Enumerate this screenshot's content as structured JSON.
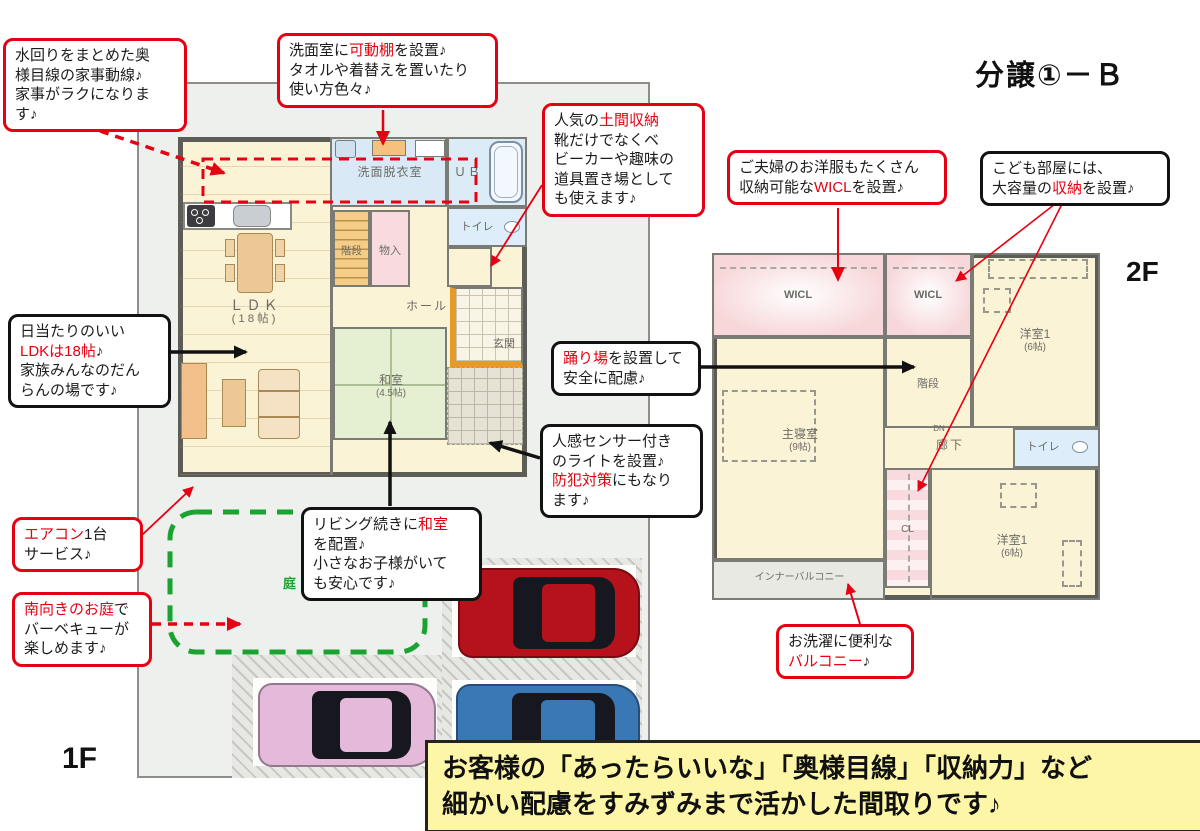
{
  "title": "分譲①－Ｂ",
  "labels": {
    "floor1": "1F",
    "floor2": "2F",
    "garden": "庭",
    "dn": "DN"
  },
  "banner": {
    "text": "お客様の「あったらいいな」「奥様目線」「収納力」など\n細かい配慮をすみずみまで活かした間取りです♪"
  },
  "colors": {
    "accent_red": "#e60012",
    "garden_green": "#1aa330",
    "banner_yellow": "#fcf6a6",
    "banner_shadow": "#f2ab52"
  },
  "callouts": {
    "mizumawari": {
      "segs": [
        {
          "t": "水回りをまとめた奥\n様目線の家事動線♪\n家事がラクになりま\nす♪"
        }
      ]
    },
    "senmen": {
      "segs": [
        {
          "t": "洗面室に"
        },
        {
          "t": "可動棚",
          "red": true
        },
        {
          "t": "を設置♪\nタオルや着替えを置いたり\n使い方色々♪"
        }
      ]
    },
    "doma": {
      "segs": [
        {
          "t": "人気の"
        },
        {
          "t": "土間収納",
          "red": true
        },
        {
          "t": "\n靴だけでなくベ\nビーカーや趣味の\n道具置き場として\nも使えます♪"
        }
      ]
    },
    "wicl": {
      "segs": [
        {
          "t": "ご夫婦のお洋服もたくさん\n収納可能な"
        },
        {
          "t": "WICL",
          "red": true
        },
        {
          "t": "を設置♪"
        }
      ]
    },
    "kodomo": {
      "segs": [
        {
          "t": "こども部屋には、\n大容量の"
        },
        {
          "t": "収納",
          "red": true
        },
        {
          "t": "を設置♪"
        }
      ]
    },
    "hiatari": {
      "segs": [
        {
          "t": "日当たりのいい\n"
        },
        {
          "t": "LDKは18帖",
          "red": true
        },
        {
          "t": "♪\n家族みんなのだん\nらんの場です♪"
        }
      ]
    },
    "odoriba": {
      "segs": [
        {
          "t": "踊り場",
          "red": true
        },
        {
          "t": "を設置して\n安全に配慮♪"
        }
      ]
    },
    "jinkan": {
      "segs": [
        {
          "t": "人感センサー付き\nのライトを設置♪\n"
        },
        {
          "t": "防犯対策",
          "red": true
        },
        {
          "t": "にもなり\nます♪"
        }
      ]
    },
    "living": {
      "segs": [
        {
          "t": "リビング続きに"
        },
        {
          "t": "和室",
          "red": true
        },
        {
          "t": "\nを配置♪\n小さなお子様がいて\nも安心です♪"
        }
      ]
    },
    "aircon": {
      "segs": [
        {
          "t": "エアコン",
          "red": true
        },
        {
          "t": "1台\nサービス♪"
        }
      ]
    },
    "minami": {
      "segs": [
        {
          "t": "南向きのお庭",
          "red": true
        },
        {
          "t": "で\nバーベキューが\n楽しめます♪"
        }
      ]
    },
    "balcony": {
      "segs": [
        {
          "t": "お洗濯に便利な\n"
        },
        {
          "t": "バルコニー",
          "red": true
        },
        {
          "t": "♪"
        }
      ]
    }
  },
  "rooms1f": {
    "senmen": "洗面脱衣室",
    "ub": "ＵＢ",
    "toilet": "トイレ",
    "stairs": "階段",
    "mono": "物入",
    "hall": "ホール",
    "genkan": "玄関",
    "ldk": "ＬＤＫ",
    "ldk_size": "(18帖)",
    "washitsu": "和室",
    "washitsu_size": "(4.5帖)"
  },
  "rooms2f": {
    "wicl1": "WICL",
    "wicl2": "WICL",
    "yoshitsu_a": "洋室1",
    "yoshitsu_a_size": "(6帖)",
    "shusinshitsu": "主寝室",
    "shusinshitsu_size": "(9帖)",
    "stairs": "階段",
    "rouka": "廊下",
    "toilet": "トイレ",
    "cl": "CL",
    "yoshitsu_b": "洋室1",
    "yoshitsu_b_size": "(6帖)",
    "balcony": "インナーバルコニー"
  }
}
